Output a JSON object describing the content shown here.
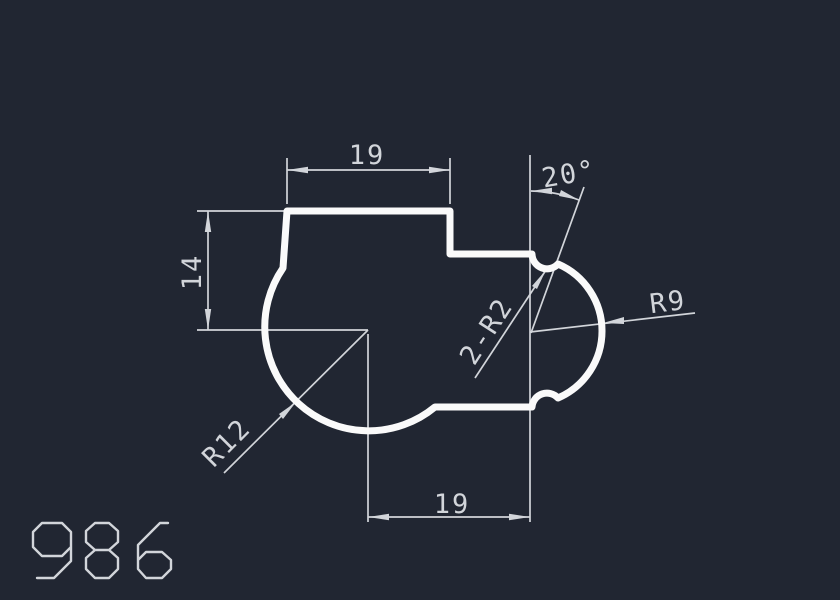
{
  "colors": {
    "background": "#212632",
    "profile": "#fafafa",
    "dimension": "#d2d5da",
    "text": "#d2d5da"
  },
  "drawing": {
    "number": "986",
    "profile_path": "M287,211 L450,211 L450,254 L532,254 A15,15 0 0 0 558,264 A73,73 0 0 1 558,398 A15,15 0 0 0 532,407 L435,407 A104,104 0 0 1 283,268 Z",
    "number_glyphs": {
      "nine": "M37,578 L54,578 L71,561 L71,532 L62,523 L42,523 L33,532 L33,547 L42,556 L62,556 L71,547",
      "eight": "M95,523 L109,523 L118,531 L118,542 L109,550 L95,550 L86,542 L86,531 Z M95,550 L109,550 L118,558 L118,569 L109,578 L95,578 L86,569 L86,558 Z",
      "six": "M168,523 L160,523 L138,545 L138,569 L146,578 L162,578 L171,569 L171,560 L162,552 L146,552 L138,560"
    }
  },
  "labels": {
    "top_width": "19",
    "bottom_width": "19",
    "left_height": "14",
    "angle": "20°",
    "radius_right": "R9",
    "radius_body": "R12",
    "fillet_notches": "2-R2"
  }
}
